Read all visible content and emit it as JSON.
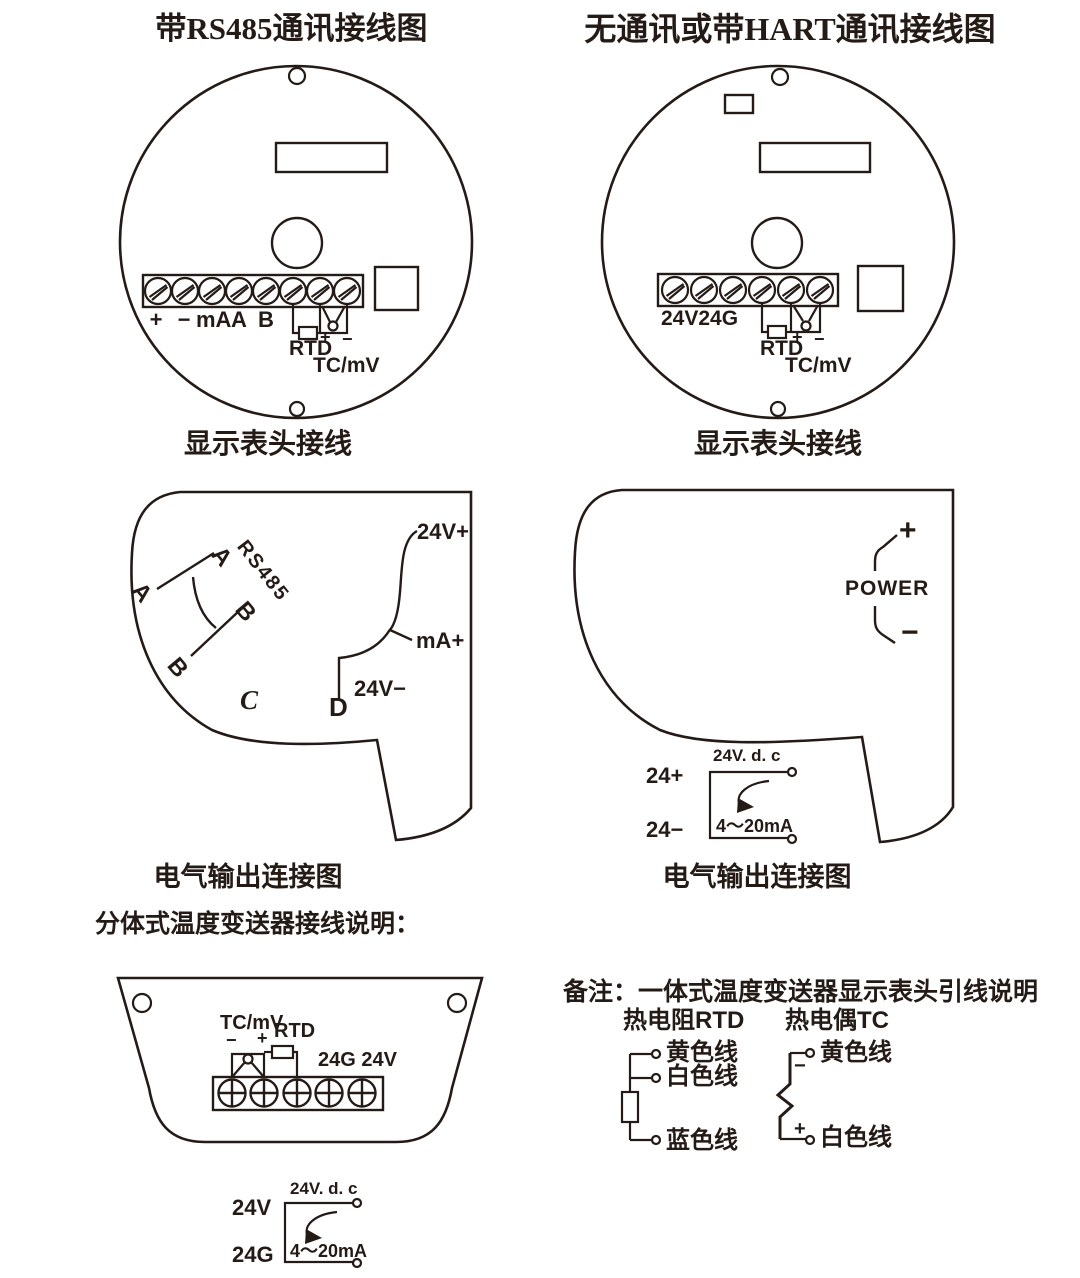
{
  "ink": "#241a16",
  "left_wiring": {
    "title": "带RS485通讯接线图",
    "caption": "显示表头接线",
    "t_plus": "+",
    "t_minus": "−",
    "t_ma": "mA",
    "t_a": "A",
    "t_b": "B",
    "rtd": "RTD",
    "rtd_plus": "+",
    "rtd_minus": "−",
    "tc": "TC/mV"
  },
  "right_wiring": {
    "title": "无通讯或带HART通讯接线图",
    "caption": "显示表头接线",
    "power_terms": "24V24G",
    "rtd": "RTD",
    "rtd_plus": "+",
    "rtd_minus": "−",
    "tc": "TC/mV"
  },
  "left_output": {
    "caption": "电气输出连接图",
    "a_outer": "A",
    "a_inner": "A",
    "rs485": "RS485",
    "b_inner": "B",
    "b_outer": "B",
    "c": "C",
    "d": "D",
    "v_plus": "24V+",
    "ma_plus": "mA+",
    "v_minus": "24V−"
  },
  "right_output": {
    "caption": "电气输出连接图",
    "plus": "+",
    "power": "POWER",
    "minus": "−",
    "supply": {
      "title": "24V. d. c",
      "pos": "24+",
      "neg": "24−",
      "range": "4～20mA"
    }
  },
  "split_section": {
    "heading": "分体式温度变送器接线说明：",
    "tc": "TC/mV",
    "minus": "−",
    "plus": "+",
    "rtd": "RTD",
    "power_terms": "24G 24V",
    "supply": {
      "title": "24V. d. c",
      "pos": "24V",
      "neg": "24G",
      "range": "4～20mA"
    }
  },
  "note_section": {
    "note": "备注：一体式温度变送器显示表头引线说明",
    "rtd_title": "热电阻RTD",
    "tc_title": "热电偶TC",
    "rtd_wire_1": "黄色线",
    "rtd_wire_2": "白色线",
    "rtd_wire_3": "蓝色线",
    "tc_minus": "−",
    "tc_plus": "+",
    "tc_wire_1": "黄色线",
    "tc_wire_2": "白色线"
  }
}
